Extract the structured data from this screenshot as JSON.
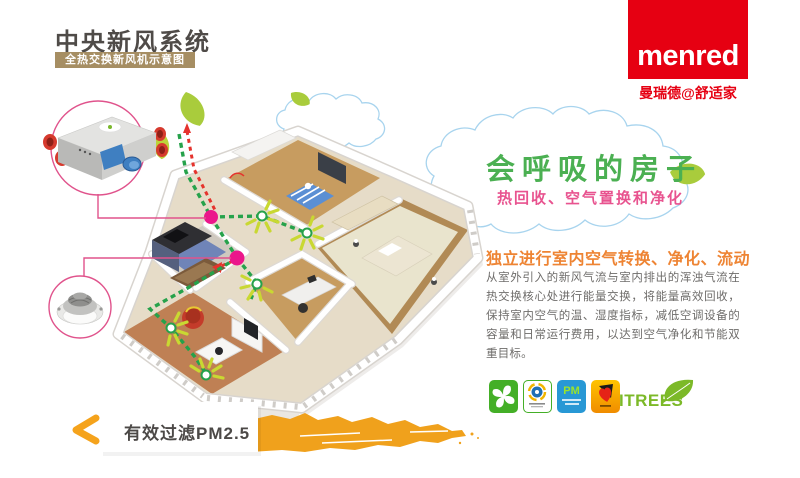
{
  "header": {
    "title": "中央新风系统",
    "subtitle": "全热交换新风机示意图"
  },
  "brand": {
    "logo": "menred",
    "tagline": "曼瑞德@舒适家"
  },
  "hero": {
    "title": "会呼吸的房子",
    "subtitle": "热回收、空气置换和净化"
  },
  "description": {
    "heading": "独立进行室内空气转换、净化、流动",
    "body": "从室外引入的新风气流与室内排出的浑浊气流在热交换核心处进行能量交换，将能量高效回收，保持室内空气的温、湿度指标，减低空调设备的容量和日常运行费用，以达到空气净化和节能双重目标。"
  },
  "badges": {
    "pm_label": "PM",
    "itrees_label": "ITREES"
  },
  "footer": {
    "filter_label": "有效过滤PM2.5"
  },
  "colors": {
    "brand_red": "#e60012",
    "title_bar_tan": "#a68e63",
    "hero_green": "#4bb052",
    "hero_pink": "#e8538f",
    "heading_orange": "#ee8433",
    "body_gray": "#6e6c6a",
    "brush_orange": "#f0a11c",
    "duct_green": "#26a24b",
    "duct_red": "#e5332d",
    "node_pink": "#eb168b",
    "ray_yellow": "#c9d832"
  }
}
